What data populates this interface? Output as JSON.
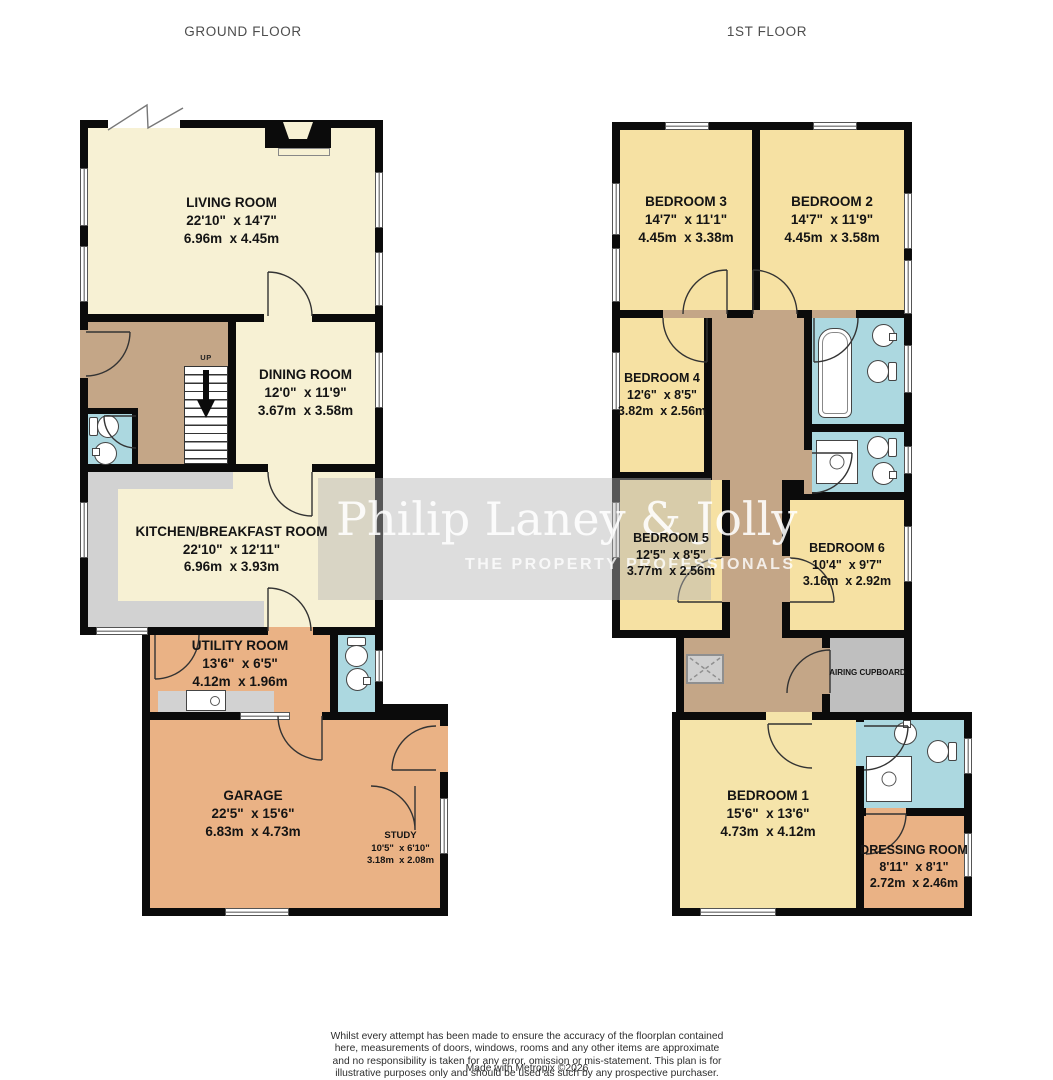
{
  "floors": {
    "ground": "GROUND FLOOR",
    "first": "1ST FLOOR"
  },
  "ground": {
    "living": {
      "name": "LIVING ROOM",
      "imp": "22'10\"  x 14'7\"",
      "met": "6.96m  x 4.45m"
    },
    "dining": {
      "name": "DINING ROOM",
      "imp": "12'0\"  x 11'9\"",
      "met": "3.67m  x 3.58m"
    },
    "kitchen": {
      "name": "KITCHEN/BREAKFAST ROOM",
      "imp": "22'10\"  x 12'11\"",
      "met": "6.96m  x 3.93m"
    },
    "utility": {
      "name": "UTILITY ROOM",
      "imp": "13'6\"  x 6'5\"",
      "met": "4.12m  x 1.96m"
    },
    "garage": {
      "name": "GARAGE",
      "imp": "22'5\"  x 15'6\"",
      "met": "6.83m  x 4.73m"
    },
    "study": {
      "name": "STUDY",
      "imp": "10'5\"  x 6'10\"",
      "met": "3.18m  x 2.08m"
    }
  },
  "first": {
    "bed1": {
      "name": "BEDROOM 1",
      "imp": "15'6\"  x 13'6\"",
      "met": "4.73m  x 4.12m"
    },
    "bed2": {
      "name": "BEDROOM 2",
      "imp": "14'7\"  x 11'9\"",
      "met": "4.45m  x 3.58m"
    },
    "bed3": {
      "name": "BEDROOM 3",
      "imp": "14'7\"  x 11'1\"",
      "met": "4.45m  x 3.38m"
    },
    "bed4": {
      "name": "BEDROOM 4",
      "imp": "12'6\"  x 8'5\"",
      "met": "3.82m  x 2.56m"
    },
    "bed5": {
      "name": "BEDROOM 5",
      "imp": "12'5\"  x 8'5\"",
      "met": "3.77m  x 2.56m"
    },
    "bed6": {
      "name": "BEDROOM 6",
      "imp": "10'4\"  x 9'7\"",
      "met": "3.16m  x 2.92m"
    },
    "dressing": {
      "name": "DRESSING ROOM",
      "imp": "8'11\"  x 8'1\"",
      "met": "2.72m  x 2.46m"
    },
    "airing": {
      "name": "AIRING CUPBOARD"
    }
  },
  "stairs": {
    "up": "UP"
  },
  "watermark": {
    "brand": "Philip Laney & Jolly",
    "tagline": "THE PROPERTY PROFESSIONALS"
  },
  "footer": {
    "disclaimer": "Whilst every attempt has been made to ensure the accuracy of the floorplan contained here, measurements of doors, windows, rooms and any other items are approximate and no responsibility is taken for any error, omission or mis-statement. This plan is for illustrative purposes only and should be used as such by any prospective purchaser. The services, systems and appliances shown have not been tested and no guarantee as to their operability or efficiency can be given.",
    "credit": "Made with Metropix ©2026"
  },
  "colors": {
    "wall": "#0b0b0b",
    "cream": "#f7f1d4",
    "bedroom_yellow": "#f6e1a3",
    "orange": "#eab285",
    "hall_tan": "#c4a687",
    "bathroom_blue": "#acd8e0",
    "counter_gray": "#d2d2d2",
    "airing_gray": "#bfbfbf"
  }
}
